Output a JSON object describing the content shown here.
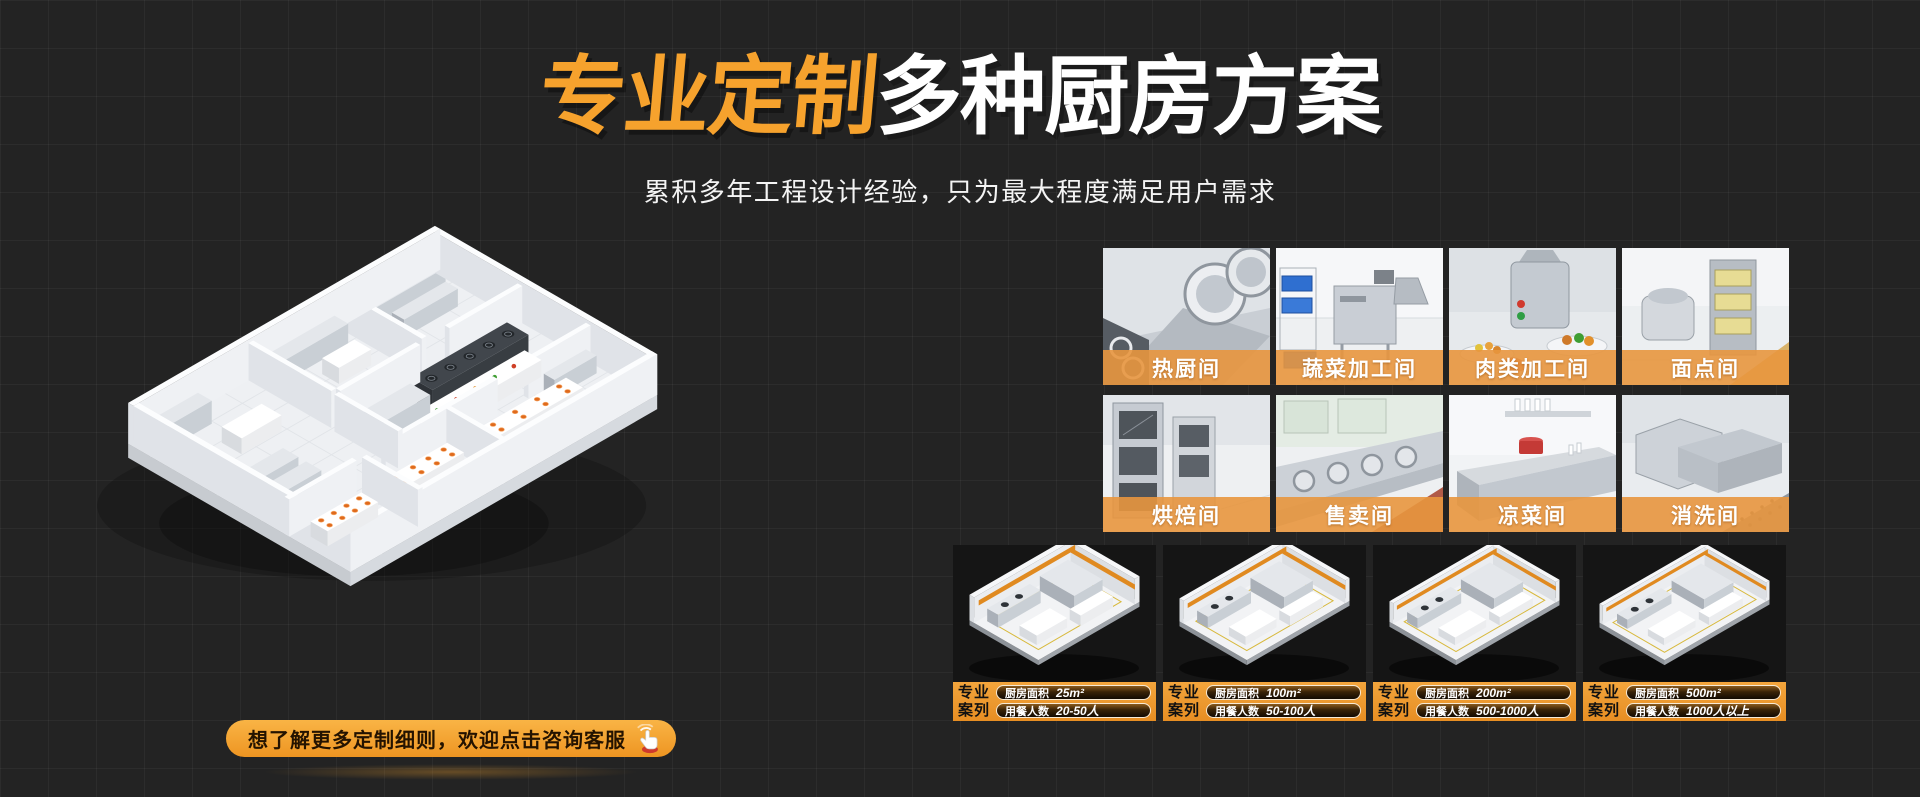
{
  "hero": {
    "title_accent": "专业定制",
    "title_rest": "多种厨房方案",
    "subtitle": "累积多年工程设计经验，只为最大程度满足用户需求"
  },
  "consult_button": {
    "label": "想了解更多定制细则，欢迎点击咨询客服"
  },
  "room_gallery": {
    "items": [
      {
        "label": "热厨间"
      },
      {
        "label": "蔬菜加工间"
      },
      {
        "label": "肉类加工间"
      },
      {
        "label": "面点间"
      },
      {
        "label": "烘焙间"
      },
      {
        "label": "售卖间"
      },
      {
        "label": "凉菜间"
      },
      {
        "label": "消洗间"
      }
    ]
  },
  "case_gallery": {
    "tag_line1": "专业",
    "tag_line2": "案列",
    "area_label": "厨房面积",
    "diners_label": "用餐人数",
    "items": [
      {
        "area": "25m²",
        "diners": "20-50人"
      },
      {
        "area": "100m²",
        "diners": "50-100人"
      },
      {
        "area": "200m²",
        "diners": "500-1000人"
      },
      {
        "area": "500m²",
        "diners": "1000人以上"
      }
    ]
  },
  "colors": {
    "background": "#232323",
    "title_orange": "#F6A22D",
    "label_bar_orange": "#E8963E",
    "case_bar_orange": "#EF9733",
    "button_orange": "#F2A138"
  }
}
